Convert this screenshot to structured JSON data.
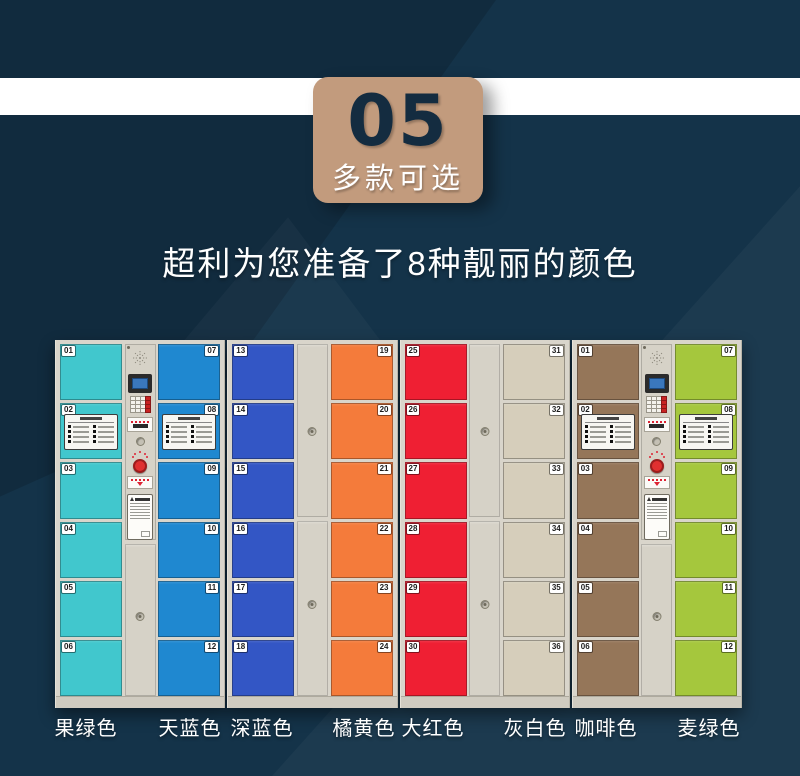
{
  "badge": {
    "number": "05",
    "subtitle": "多款可选"
  },
  "headline": "超利为您准备了8种靓丽的颜色",
  "color_labels": [
    "果绿色",
    "天蓝色",
    "深蓝色",
    "橘黄色",
    "大红色",
    "灰白色",
    "咖啡色",
    "麦绿色"
  ],
  "palette": {
    "background": "#143349",
    "band": "#FFFFFF",
    "badge": "#C29B7D",
    "badge_number": "#142C40",
    "cabinet_frame": "#D9D5CB",
    "fruit_green": "#41C7CD",
    "sky_blue": "#1F88D0",
    "deep_blue": "#3356C5",
    "orange": "#F47B3B",
    "red": "#EF1F33",
    "gray_white": "#D6CEBB",
    "coffee": "#957659",
    "wheat_green": "#A5C73D"
  },
  "cabinets": [
    {
      "middle": "control-panel",
      "left_doors": {
        "color": "果绿色",
        "hex": "#41C7CD",
        "numbers": [
          "01",
          "02",
          "03",
          "04",
          "05",
          "06"
        ],
        "sticker_door": 1
      },
      "right_doors": {
        "color": "天蓝色",
        "hex": "#1F88D0",
        "numbers": [
          "07",
          "08",
          "09",
          "10",
          "11",
          "12"
        ],
        "sticker_door": 1
      }
    },
    {
      "middle": "plain",
      "left_doors": {
        "color": "深蓝色",
        "hex": "#3356C5",
        "numbers": [
          "13",
          "14",
          "15",
          "16",
          "17",
          "18"
        ],
        "sticker_door": -1
      },
      "right_doors": {
        "color": "橘黄色",
        "hex": "#F47B3B",
        "numbers": [
          "19",
          "20",
          "21",
          "22",
          "23",
          "24"
        ],
        "sticker_door": -1
      }
    },
    {
      "middle": "plain",
      "left_doors": {
        "color": "大红色",
        "hex": "#EF1F33",
        "numbers": [
          "25",
          "26",
          "27",
          "28",
          "29",
          "30"
        ],
        "sticker_door": -1
      },
      "right_doors": {
        "color": "灰白色",
        "hex": "#D6CEBB",
        "numbers": [
          "31",
          "32",
          "33",
          "34",
          "35",
          "36"
        ],
        "sticker_door": -1
      }
    },
    {
      "middle": "control-panel",
      "left_doors": {
        "color": "咖啡色",
        "hex": "#957659",
        "numbers": [
          "01",
          "02",
          "03",
          "04",
          "05",
          "06"
        ],
        "sticker_door": 1
      },
      "right_doors": {
        "color": "麦绿色",
        "hex": "#A5C73D",
        "numbers": [
          "07",
          "08",
          "09",
          "10",
          "11",
          "12"
        ],
        "sticker_door": 1
      }
    }
  ]
}
